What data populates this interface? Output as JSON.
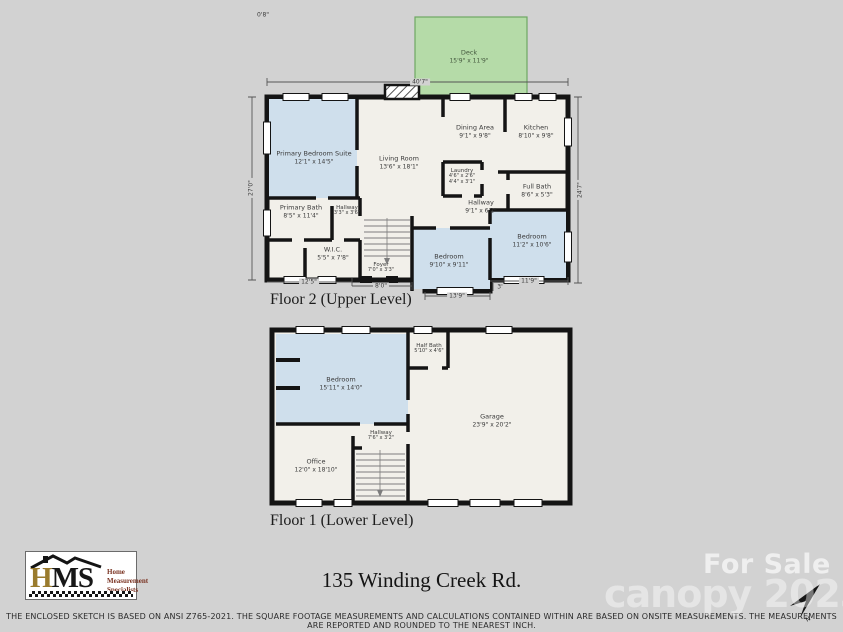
{
  "colors": {
    "background": "#d2d2d2",
    "wall": "#141414",
    "room_fill": "#f2f0ea",
    "blue_room_fill": "#cfdfec",
    "deck_fill": "#b5dba8",
    "deck_border": "#6ea763",
    "dimension_line": "#555555",
    "logo_gold": "#9a7b2d",
    "logo_words": "#7a3322",
    "watermark": "#ffffff"
  },
  "annotations": {
    "top_left_note": "0'8\""
  },
  "deck": {
    "name": "Deck",
    "dims": "15'9\" x 11'9\""
  },
  "floor2": {
    "title": "Floor 2 (Upper Level)",
    "dimensions": {
      "top": "40'7\"",
      "left": "27'0\"",
      "right": "24'7\"",
      "bottom_left": "12'5\"",
      "bottom_mid": "8'0\"",
      "bottom_bedroom": "13'9\"",
      "bottom_right": "11'9\"",
      "offset": "3'"
    },
    "rooms": [
      {
        "name": "Primary Bedroom Suite",
        "dims": "12'1\" x 14'5\""
      },
      {
        "name": "Living Room",
        "dims": "13'6\" x 18'1\""
      },
      {
        "name": "Dining Area",
        "dims": "9'1\" x 9'8\""
      },
      {
        "name": "Kitchen",
        "dims": "8'10\" x 9'8\""
      },
      {
        "name": "Laundry",
        "dims": "4'6\" x 2'6\"",
        "dims2": "4'4\" x 3'1\""
      },
      {
        "name": "Full Bath",
        "dims": "8'6\" x 5'3\""
      },
      {
        "name": "Hallway",
        "dims": "9'1\" x 6'2\""
      },
      {
        "name": "Primary Bath",
        "dims": "8'5\" x 11'4\""
      },
      {
        "name": "Hallway",
        "dims": "3'3\" x 3'6\""
      },
      {
        "name": "W.I.C.",
        "dims": "5'5\" x 7'8\""
      },
      {
        "name": "Foyer",
        "dims": "7'0\" x 3'3\""
      },
      {
        "name": "Bedroom",
        "dims": "9'10\" x 9'11\""
      },
      {
        "name": "Bedroom",
        "dims": "11'2\" x 10'6\""
      }
    ]
  },
  "floor1": {
    "title": "Floor 1 (Lower Level)",
    "rooms": [
      {
        "name": "Bedroom",
        "dims": "15'11\" x 14'0\""
      },
      {
        "name": "Half Bath",
        "dims": "5'10\" x 4'6\""
      },
      {
        "name": "Garage",
        "dims": "23'9\" x 20'2\""
      },
      {
        "name": "Hallway",
        "dims": "7'6\" x 3'2\""
      },
      {
        "name": "Office",
        "dims": "12'0\" x 18'10\""
      }
    ]
  },
  "footer": {
    "logo": {
      "acronym_h": "H",
      "acronym_ms": "MS",
      "line1": "Home",
      "line2": "Measurement",
      "line3": "Specialists"
    },
    "address": "135 Winding Creek Rd.",
    "watermark_line1": "For Sale",
    "watermark_line2": "canopy 2023",
    "north_label": "N",
    "disclaimer": "THE ENCLOSED SKETCH IS BASED ON ANSI Z765-2021. THE SQUARE FOOTAGE MEASUREMENTS AND CALCULATIONS CONTAINED WITHIN ARE BASED ON ONSITE MEASUREMENTS. THE MEASUREMENTS ARE REPORTED AND ROUNDED TO THE NEAREST INCH."
  }
}
